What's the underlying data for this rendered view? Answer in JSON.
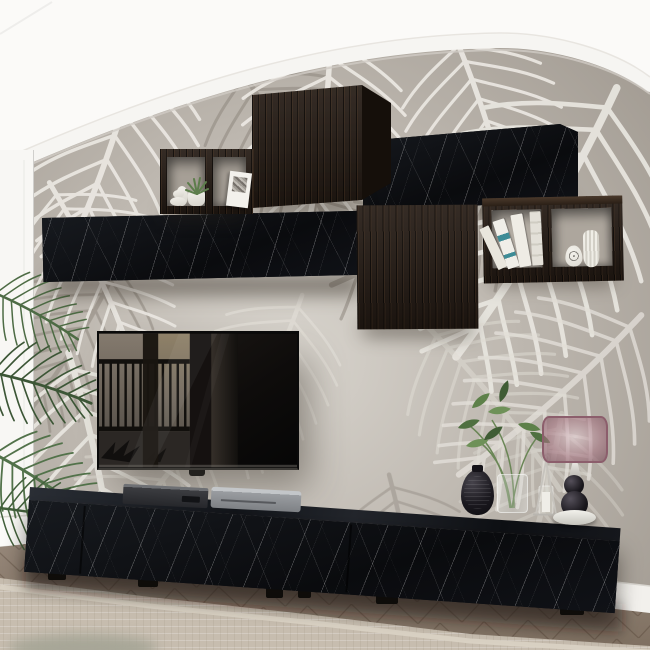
{
  "scene": {
    "subject": "Living room wall unit set in black marble and dark rustic wood",
    "setting": "arched accent wall covered in tropical palm-leaf wallpaper",
    "flooring": "herringbone wood parquet with beige area rug",
    "lighting": "soft daylight centered on the TV wall"
  },
  "colors": {
    "wall_white": "#fbfaf8",
    "wallpaper_base": "#aba49b",
    "wallpaper_light": "#d7d3cc",
    "wallpaper_dark": "#968f86",
    "frond_white": "#ebe8e2",
    "frond_taupe": "#8f887f",
    "arch_trim": "#f6f5f2",
    "pillar_white": "#f8f7f4",
    "marble_black": "#0d0e11",
    "marble_vein": "#e8e8ea",
    "wood_dark": "#261c15",
    "shelf_interior": "#a69f96",
    "floor_wood": "#8d7d6d",
    "rug_beige": "#c7bdaf",
    "rug_border": "#d9d1c3",
    "baseboard_white": "#f2f0ec",
    "tv_bezel": "#0a0a0a",
    "reflection_gray": "#7b7267",
    "device_gray": "#3c3d41",
    "device_silver": "#9a9da1",
    "plant_green": "#567647",
    "lamp_shade_mauve": "#a87885",
    "lamp_metal": "#8c5e6c",
    "ceramic_white": "#eceae4",
    "vase_black": "#17161b",
    "book_teal": "#3e8c96"
  },
  "furniture": {
    "wall_cabinets": [
      {
        "name": "dark wood cube wall cabinet",
        "finish": "rustic dark wood"
      },
      {
        "name": "black marble wall cabinet",
        "finish": "black marble"
      },
      {
        "name": "long black marble floating cabinet",
        "finish": "black marble"
      },
      {
        "name": "dark wood wall cabinet",
        "finish": "rustic dark wood"
      }
    ],
    "open_shelves": [
      {
        "name": "left open cube shelf",
        "contents": [
          "white oval vase",
          "pebble stack",
          "potted succulent",
          "leaning art print"
        ]
      },
      {
        "name": "right open cube shelf",
        "contents": [
          "four leaning books",
          "black-and-white patterned vase",
          "white ribbed vase"
        ]
      }
    ],
    "tv_console": {
      "name": "long black marble TV stand",
      "sections": 3,
      "feet": "black block feet"
    }
  },
  "electronics": {
    "tv": {
      "name": "wall-mounted flat screen TV",
      "state": "off, screen reflecting a balcony railing"
    },
    "players": [
      {
        "name": "DVD player"
      },
      {
        "name": "silver media receiver"
      }
    ]
  },
  "decor": {
    "console_items": [
      {
        "name": "black textured vase"
      },
      {
        "name": "glass vase with green branches"
      },
      {
        "name": "glass candle lantern with cone frame"
      },
      {
        "name": "table lamp with sheer dusty-rose drum shade"
      }
    ],
    "plant_left": {
      "name": "palm houseplant at left edge"
    },
    "foreground": {
      "name": "blurred object on rug"
    }
  }
}
